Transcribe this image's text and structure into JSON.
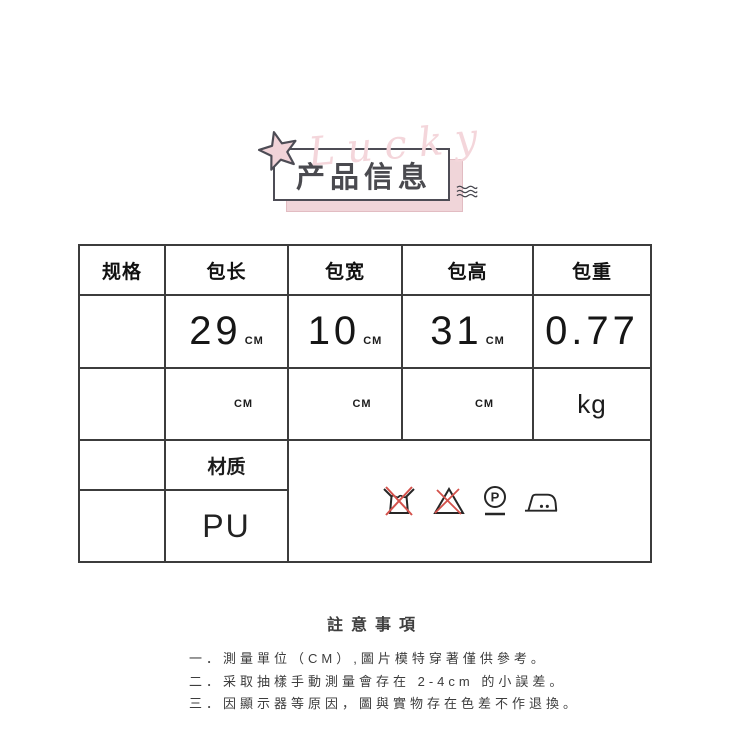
{
  "badge": {
    "title": "产品信息",
    "watermark": "Lucky"
  },
  "colors": {
    "accent_pink": "#f0d5d9",
    "title_dark": "#4a4a4f",
    "care_red": "#d4524c",
    "ink": "#262626",
    "table_border": "#3c3c3c"
  },
  "table": {
    "headers": [
      "规格",
      "包长",
      "包宽",
      "包高",
      "包重"
    ],
    "measurements": [
      {
        "label": "包长",
        "value": "29",
        "unit": "CM"
      },
      {
        "label": "包宽",
        "value": "10",
        "unit": "CM"
      },
      {
        "label": "包高",
        "value": "31",
        "unit": "CM"
      },
      {
        "label": "包重",
        "value": "0.77",
        "unit": "kg"
      }
    ],
    "material_label": "材质",
    "material_value": "PU",
    "dry_clean_letter": "P",
    "care_icons": [
      "do-not-wash",
      "do-not-bleach",
      "dry-clean-P-gentle",
      "iron-medium"
    ]
  },
  "notes": {
    "title": "註意事項",
    "items": [
      "一．測量單位（CM）,圖片模特穿著僅供參考。",
      "二．采取抽樣手動測量會存在 2-4cm 的小誤差。",
      "三．因顯示器等原因，圖與實物存在色差不作退換。"
    ]
  }
}
